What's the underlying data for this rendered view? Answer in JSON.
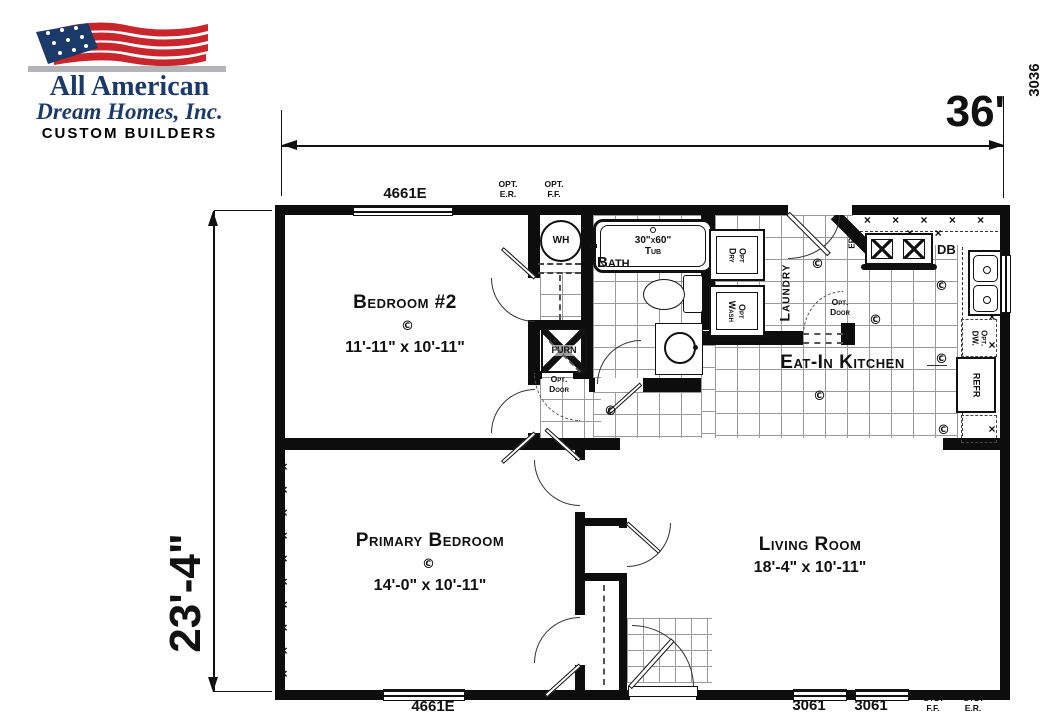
{
  "logo": {
    "title": "All American",
    "subtitle": "Dream Homes, Inc.",
    "tagline": "CUSTOM BUILDERS"
  },
  "dimensions": {
    "overall_width": "36'",
    "overall_depth": "23'-4\""
  },
  "rooms": {
    "bedroom2": {
      "name": "Bedroom #2",
      "size": "11'-11\" x 10'-11\""
    },
    "primary": {
      "name": "Primary Bedroom",
      "size": "14'-0\" x 10'-11\""
    },
    "living": {
      "name": "Living Room",
      "size": "18'-4\" x 10'-11\""
    },
    "kitchen": {
      "name": "Eat-In Kitchen"
    },
    "bath": {
      "name": "Bath"
    },
    "laundry": {
      "name": "Laundry"
    }
  },
  "fixtures": {
    "water_heater": "WH",
    "furnace": "FURN",
    "tub": "30\"x60\"\nTub",
    "opt_dryer": "Opt\nDry",
    "opt_washer": "Opt\nWash",
    "opt_dishwasher": "Opt.\nDW.",
    "refrigerator": "REFR",
    "drawer_base": "DB",
    "electrical_panel": "EPB"
  },
  "windows": {
    "top": "4661E",
    "bottom_left": "4661E",
    "bottom_right_1": "3061",
    "bottom_right_2": "3061",
    "kitchen_right": "3036"
  },
  "annotations": {
    "opt_er": "OPT.\nE.R.",
    "opt_ff": "OPT.\nF.F.",
    "std_ff": "STD.\nF.F.",
    "std_er": "STD.\nE.R.",
    "opt_door": "Opt.\nDoor",
    "ceiling_outlet": "©"
  },
  "symbols": {
    "marriage_wall_marks": "×\n×\n×\n×\n×\n×\n×\n×\n×\n×",
    "counter_marks_top": "× × × × × × ×",
    "counter_marks_right": "×\n×\n×\n×\n×\n×\n×"
  }
}
